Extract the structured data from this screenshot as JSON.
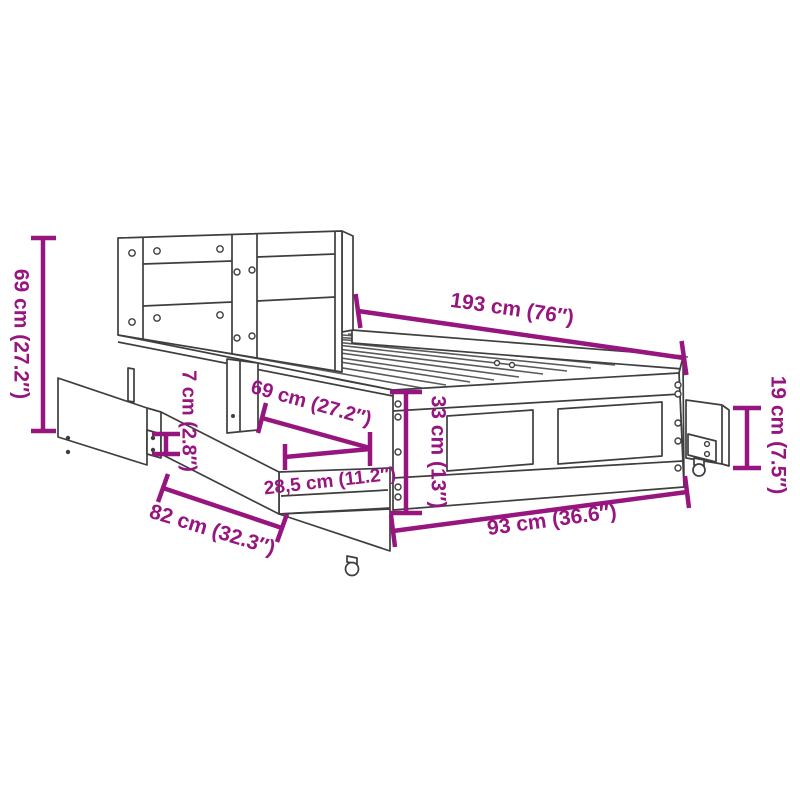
{
  "title": "Bed frame with headboard and drawers — dimension diagram",
  "colors": {
    "dimension": "#97157F",
    "line_art": "#3E3E3E",
    "background": "#FFFFFF"
  },
  "dimensions": {
    "overall_height": {
      "label": "69 cm (27.2″)"
    },
    "overall_length": {
      "label": "193 cm (76″)"
    },
    "headboard_thickness": {
      "label": "7 cm (2.8″)"
    },
    "drawer_depth": {
      "label": "69 cm (27.2″)"
    },
    "drawer_inner_height": {
      "label": "28,5 cm (11.2″)"
    },
    "drawer_width": {
      "label": "82 cm (32.3″)"
    },
    "frame_width": {
      "label": "93 cm (36.6″)"
    },
    "frame_height": {
      "label": "33 cm (13″)"
    },
    "side_drawer_height": {
      "label": "19 cm (7.5″)"
    }
  }
}
